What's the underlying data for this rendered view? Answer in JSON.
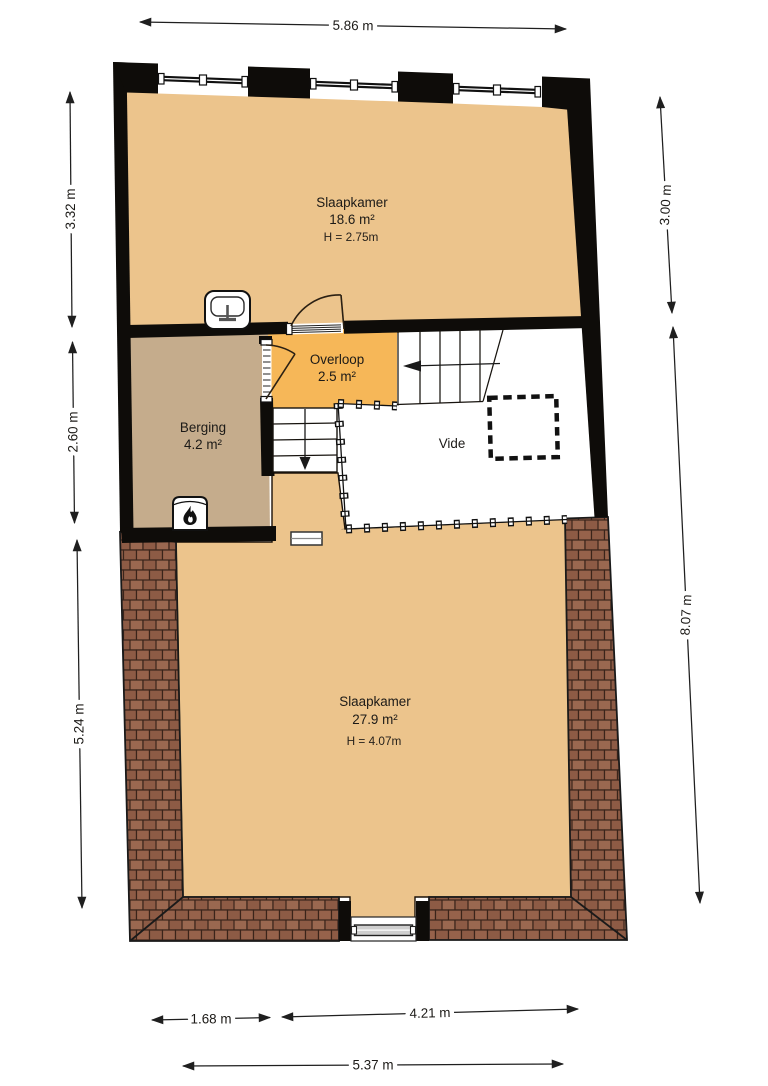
{
  "plan": {
    "title": "floor-plan-second-floor",
    "rooms": {
      "bedroom1": {
        "name": "Slaapkamer",
        "area": "18.6 m²",
        "height": "H = 2.75m"
      },
      "landing": {
        "name": "Overloop",
        "area": "2.5 m²"
      },
      "storage": {
        "name": "Berging",
        "area": "4.2 m²"
      },
      "void": {
        "name": "Vide"
      },
      "bedroom2": {
        "name": "Slaapkamer",
        "area": "27.9 m²",
        "height": "H = 4.07m"
      }
    },
    "dimensions": {
      "top": "5.86 m",
      "left_upper": "3.32 m",
      "left_middle": "2.60 m",
      "left_lower": "5.24 m",
      "right_upper": "3.00 m",
      "right_lower": "8.07 m",
      "bottom_left": "1.68 m",
      "bottom_right": "4.21 m",
      "bottom_total": "5.37 m"
    },
    "colors": {
      "floor_tan": "#ECC48C",
      "landing_orange": "#F6B758",
      "storage_taupe": "#C5AC8C",
      "wall_black": "#0E0C09",
      "roof_brown": "#8D5B45",
      "roof_joint": "#3A241A",
      "vide_white": "#FFFFFF",
      "dimension_line": "#1F1F1F"
    }
  }
}
